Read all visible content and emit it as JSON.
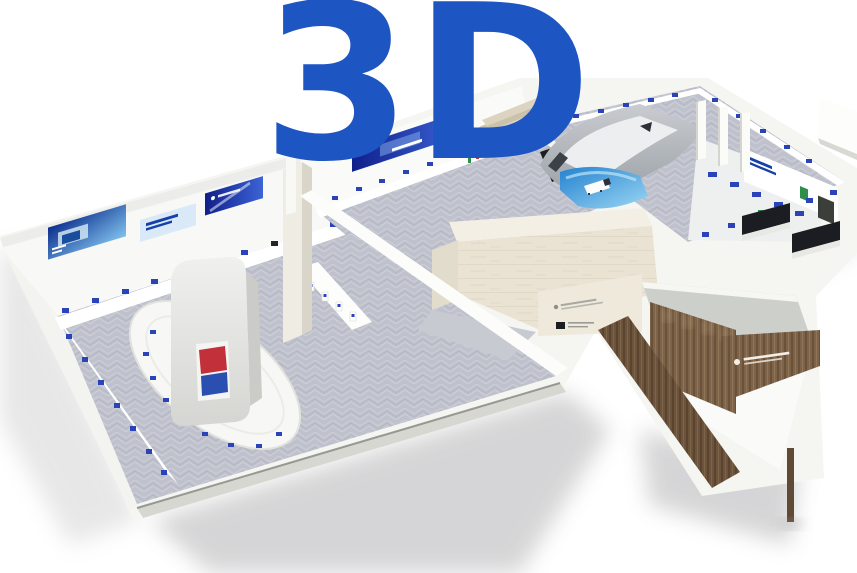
{
  "logo": {
    "text": "3D",
    "color": "#1d55c3"
  },
  "palette": {
    "white_wall": "#f5f5f2",
    "wall_shade": "#dedcd5",
    "carpet": "#bfc2cd",
    "travertine": "#eae3d4",
    "roof_gray": "#cdcfcb",
    "hull_gray": "#cfd2d6",
    "pool_blue": "#2f8fd9",
    "banner_deep_blue": "#13239b",
    "banner_light": "#d9e9f8",
    "exhibit_blue": "#2a43b8",
    "exhibit_green": "#2e8f4a",
    "exhibit_dark": "#23252a",
    "exhibit_red": "#b0402f",
    "screen_red": "#c2303a",
    "screen_blue": "#2b4fb0",
    "wood": "#7d6349",
    "wood_dark": "#5f4a35",
    "black_zone": "#1b1d22"
  },
  "zones": [
    {
      "id": "left-exhibition-hall"
    },
    {
      "id": "media-totem-island"
    },
    {
      "id": "central-gallery-hall"
    },
    {
      "id": "travertine-pavilion"
    },
    {
      "id": "rear-hall"
    },
    {
      "id": "east-corridor"
    },
    {
      "id": "wood-entrance"
    }
  ]
}
